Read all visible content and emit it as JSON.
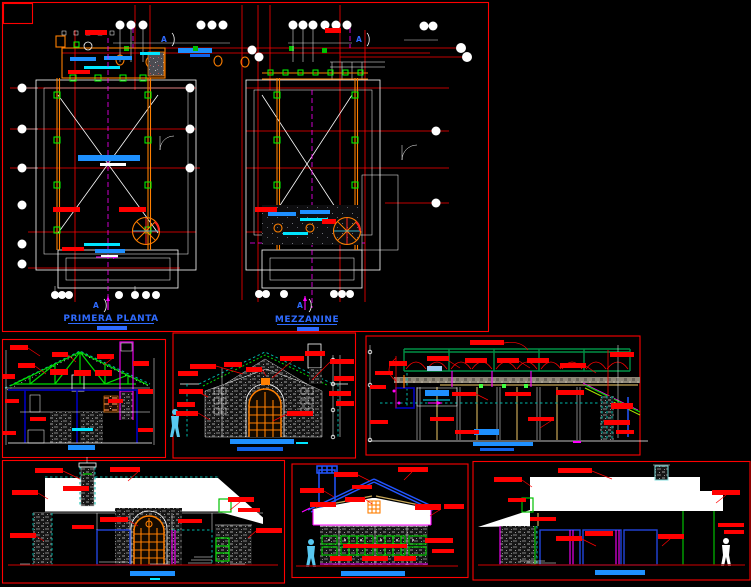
{
  "sheet": {
    "type": "cad-architectural-drawing",
    "background": "#000000",
    "plan_labels": {
      "primera": "PRIMERA PLANTA",
      "mezzanine": "MEZZANINE"
    },
    "section_marker": "A",
    "panels": [
      {
        "id": "floor-plans",
        "content": "two floor plans with grid bubbles, section line A"
      },
      {
        "id": "section-transversal",
        "content": "cross section with green roof truss and chimney"
      },
      {
        "id": "front-elevation",
        "content": "gable facade with arched door and human figure"
      },
      {
        "id": "section-longitudinal",
        "content": "long section with green top truss band"
      },
      {
        "id": "main-elevation",
        "content": "elevation with white roof band, chimney, arched door"
      },
      {
        "id": "rear-elevation",
        "content": "rear elevation with blue roof and green window band"
      },
      {
        "id": "side-elevation",
        "content": "side elevation with white roof, blue window frames"
      }
    ],
    "colors": {
      "annotation_red": "#ff0000",
      "title_blue": "#2f6bff",
      "wall_orange": "#ff7f00",
      "truss_green": "#00dd00",
      "centerline_magenta": "#ff00ff",
      "detail_cyan": "#00e5ff",
      "furniture_blue": "#1e90ff",
      "roof_line_blue": "#2255ff",
      "eave_tan": "#c8a858",
      "ground_dark_red": "#8b0000",
      "figure_light_blue": "#58c8f0"
    }
  }
}
